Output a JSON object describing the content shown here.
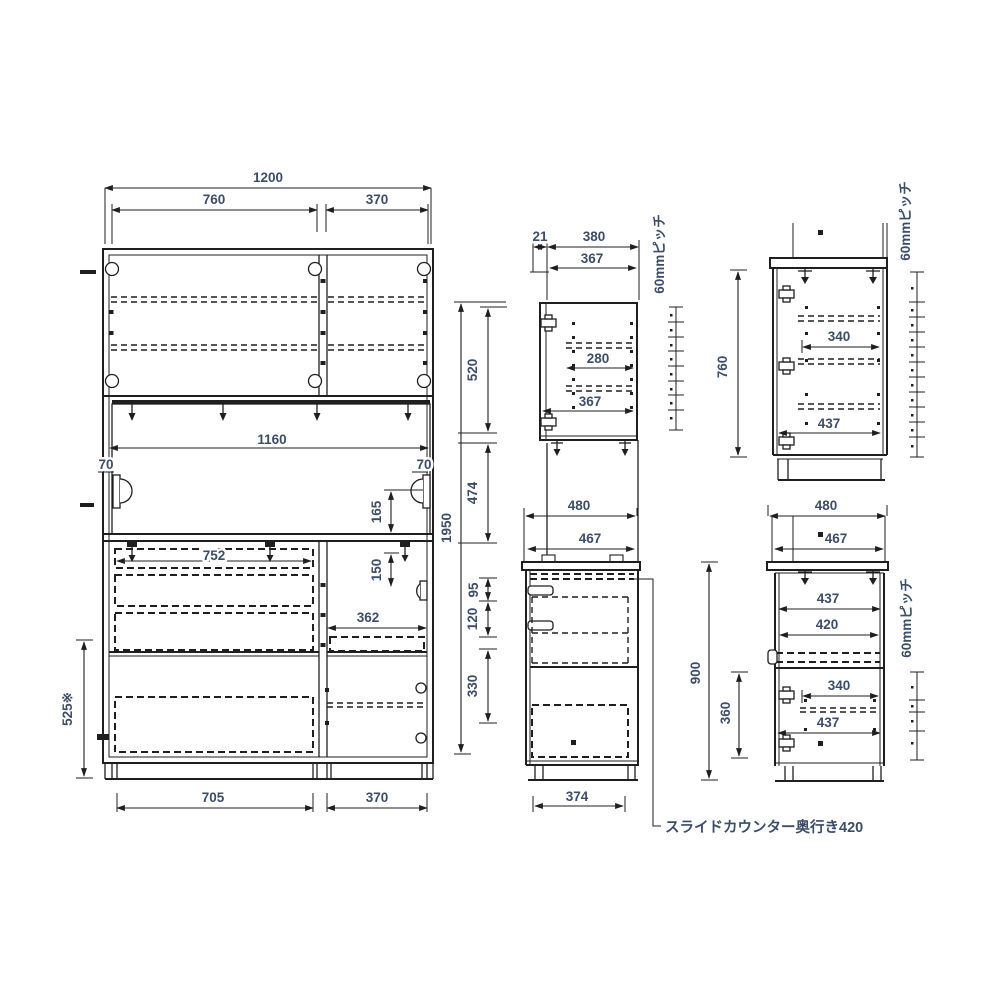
{
  "colors": {
    "line": "#1f1f1f",
    "dim_text": "#3b4d69",
    "background": "#ffffff"
  },
  "front_view": {
    "total_width": "1200",
    "upper_left_width": "760",
    "upper_right_width": "370",
    "niche_width": "1160",
    "handle_clearance_left": "70",
    "handle_clearance_right": "70",
    "handle_height": "165",
    "drawer_inner_width": "752",
    "right_handle_height": "150",
    "right_inner_width": "362",
    "left_lower_height": "525※",
    "bottom_left_width": "705",
    "bottom_right_width": "370",
    "total_height": "1950",
    "upper_section_height": "520",
    "middle_section_height": "474",
    "drawer1_height": "95",
    "drawer2_height": "120",
    "drawer3_height": "330"
  },
  "upper_side_view": {
    "back_offset": "21",
    "total_depth": "380",
    "inner_depth": "367",
    "shelf_depth": "280",
    "bottom_inner_depth": "367",
    "shelf_pitch": "60mmピッチ"
  },
  "lower_side_view": {
    "counter_depth": "480",
    "inner_depth": "467",
    "base_depth": "374",
    "slide_counter_note": "スライドカウンター奥行き420"
  },
  "upper_side_view_right": {
    "total_height": "760",
    "shelf_depth": "340",
    "inner_depth": "437",
    "shelf_pitch": "60mmピッチ"
  },
  "lower_side_view_right": {
    "counter_depth": "480",
    "counter_inner_depth": "467",
    "total_height": "900",
    "upper_inner_depth": "437",
    "slide_depth": "420",
    "lower_section_height": "360",
    "shelf_depth": "340",
    "lower_inner_depth": "437",
    "shelf_pitch": "60mmピッチ"
  }
}
